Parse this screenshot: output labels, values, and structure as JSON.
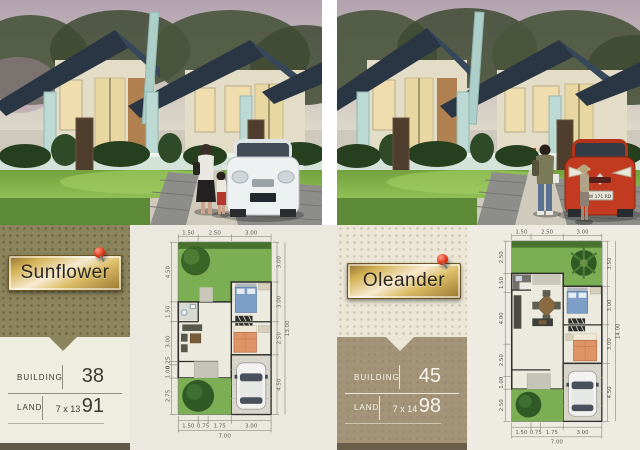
{
  "photos": {
    "right_plate": "W 171 RD"
  },
  "sunflower": {
    "name": "Sunflower",
    "building_label": "BUILDING",
    "building_value": "38",
    "land_label": "LAND",
    "land_dims": "7 x 13",
    "land_value": "91",
    "plan": {
      "top_dims": [
        "1.50",
        "2.50",
        "3.00"
      ],
      "bottom_dims": [
        "1.50",
        "0.75",
        "1.75",
        "3.00"
      ],
      "bottom_total": "7.00",
      "left_dims": [
        "4.50",
        "1.50",
        "3.00",
        "0.25",
        "1.00",
        "2.75"
      ],
      "right_dims": [
        "3.00",
        "3.00",
        "2.50",
        "4.50"
      ],
      "right_total": "13.00"
    }
  },
  "oleander": {
    "name": "Oleander",
    "building_label": "BUILDING",
    "building_value": "45",
    "land_label": "LAND",
    "land_dims": "7 x 14",
    "land_value": "98",
    "plan": {
      "top_dims": [
        "1.50",
        "2.50",
        "3.00"
      ],
      "bottom_dims": [
        "1.50",
        "0.75",
        "1.75",
        "3.00"
      ],
      "bottom_total": "7.00",
      "left_dims": [
        "2.50",
        "1.50",
        "4.00",
        "2.50",
        "1.00",
        "2.50"
      ],
      "right_dims": [
        "3.50",
        "3.00",
        "3.00",
        "4.50"
      ],
      "right_total": "14.00"
    }
  }
}
